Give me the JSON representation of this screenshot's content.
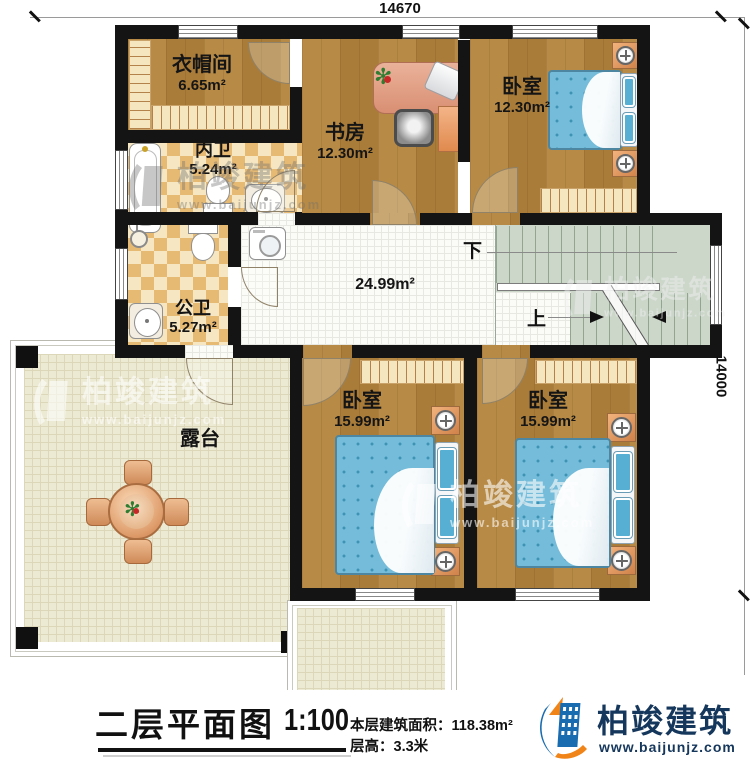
{
  "dimensions": {
    "top": "14670",
    "right": "14000"
  },
  "rooms": {
    "cloakroom": {
      "name": "衣帽间",
      "area": "6.65m²"
    },
    "study": {
      "name": "书房",
      "area": "12.30m²"
    },
    "bedroom_top": {
      "name": "卧室",
      "area": "12.30m²"
    },
    "inner_bath": {
      "name": "内卫",
      "area": "5.24m²"
    },
    "public_bath": {
      "name": "公卫",
      "area": "5.27m²"
    },
    "hallway": {
      "area": "24.99m²"
    },
    "terrace": {
      "name": "露台"
    },
    "bedroom_left": {
      "name": "卧室",
      "area": "15.99m²"
    },
    "bedroom_right": {
      "name": "卧室",
      "area": "15.99m²"
    }
  },
  "stairs": {
    "down": "下",
    "up": "上"
  },
  "footer": {
    "title": "二层平面图",
    "scale": "1:100",
    "floor_area_label": "本层建筑面积：118.38m²",
    "floor_height_label": "层高：3.3米",
    "brand": "柏竣建筑",
    "website": "www.baijunjz.com"
  },
  "watermark": {
    "brand": "柏竣建筑",
    "website": "www.baijunjz.com"
  }
}
